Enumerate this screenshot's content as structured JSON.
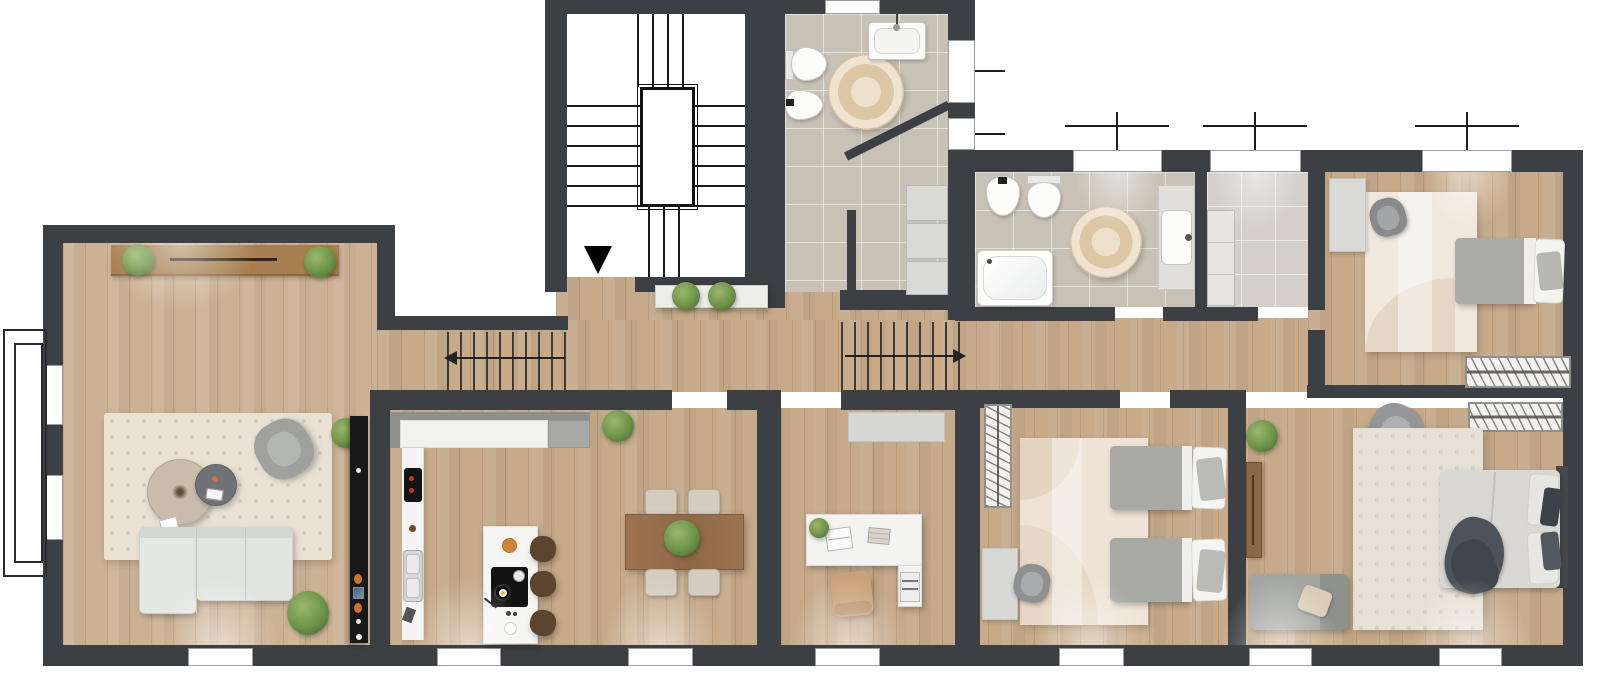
{
  "document": {
    "type": "architectural floor plan",
    "style": "top-down 2D rendered apartment plan, no text labels",
    "wall_color": "#3c3f43",
    "background": "#ffffff"
  },
  "rooms": [
    {
      "id": "stairwell",
      "name": "Stairwell",
      "features": [
        "U-shaped staircase",
        "central stair void",
        "black entry arrow pointing down"
      ]
    },
    {
      "id": "bathroom-1",
      "name": "Bathroom 1",
      "floor": "beige tile",
      "fixtures": [
        "wall-hung toilet",
        "bidet",
        "washbasin with faucet",
        "round jute rug",
        "stacked storage cabinets",
        "diagonal partition wall"
      ],
      "windows": 3
    },
    {
      "id": "entry-hall",
      "name": "Entry hall",
      "furniture": [
        "white console shelf with two green plants"
      ]
    },
    {
      "id": "hallway",
      "name": "Hallway",
      "features": [
        "stair run hatch with arrow pointing left",
        "stair run hatch with arrow pointing right"
      ]
    },
    {
      "id": "bathroom-2",
      "name": "Bathroom 2",
      "floor": "beige tile",
      "fixtures": [
        "bidet",
        "toilet",
        "bathtub",
        "vanity with washbasin",
        "round jute rug"
      ],
      "windows": 1
    },
    {
      "id": "laundry",
      "name": "Laundry / utility room",
      "floor": "light tile",
      "furniture": [
        "tall storage cabinet"
      ],
      "windows": 1
    },
    {
      "id": "bedroom-1",
      "name": "Single bedroom",
      "furniture": [
        "single bed with grey duvet and white pillow",
        "desk",
        "grey swivel chair",
        "cream area rug",
        "radiator / hatched low unit"
      ],
      "windows": 1
    },
    {
      "id": "living-room",
      "name": "Living room",
      "furniture": [
        "wooden sideboard flanked by two plants",
        "L-shaped light grey sofa",
        "large round coffee table",
        "small dark round side table",
        "grey armchair",
        "cream area rug",
        "dark media / aquarium column with decor",
        "two more potted plants"
      ],
      "windows": 4
    },
    {
      "id": "kitchen-dining",
      "name": "Kitchen and dining area",
      "furniture": [
        "wall counter with sink and coffee machine",
        "upper cabinet row",
        "fridge block",
        "island with black cooktop and pan",
        "three brown bar stools",
        "wooden dining table",
        "four beige chairs",
        "table centerpiece plant",
        "doorway plant"
      ],
      "windows": 2
    },
    {
      "id": "office",
      "name": "Home office",
      "furniture": [
        "L-shaped white desk",
        "laptop",
        "desk plant",
        "books",
        "magazine file",
        "tan office chair",
        "grey wall shelf"
      ],
      "windows": 1
    },
    {
      "id": "kids-bedroom",
      "name": "Kids bedroom",
      "furniture": [
        "two single beds with grey duvets and white pillows",
        "hatched wardrobe",
        "desk",
        "grey swivel chair",
        "beige area rug"
      ],
      "windows": 1
    },
    {
      "id": "master-bedroom",
      "name": "Master bedroom",
      "furniture": [
        "double bed with dark throw and layered pillows",
        "hatched wardrobe",
        "chest of drawers",
        "grey armchair",
        "chaise lounge with beige cushion",
        "large speckled rug",
        "corner plant"
      ],
      "windows": 2
    }
  ],
  "symbols": {
    "entry_arrow": "solid black triangle pointing down at stairwell landing",
    "stair_direction_left": "hallway stair hatch, arrow points left",
    "stair_direction_right": "hallway stair hatch, arrow points right",
    "window_casement_marks": "thin perpendicular tick lines outside top and side windows",
    "balcony_outline": "double rectangle railing outline outside the left living-room windows"
  },
  "counts": {
    "rooms": 12,
    "bottom_windows": 7,
    "top_windows": 3,
    "left_windows": 2,
    "courtyard_side_windows": 3,
    "beds": 4,
    "bar_stools": 3,
    "dining_chairs": 4,
    "plants": 10
  },
  "palette": {
    "wall": "#3c3f43",
    "wood_floor": "#c6aa8a",
    "living_floor": "#ccb295",
    "tile_floor": "#c8c1b6",
    "tile_light": "#d4d0c9",
    "rug_cream": "#e9e1d4",
    "sofa_grey": "#e2e4e1",
    "duvet_grey": "#a7a9a2",
    "sideboard_wood": "#a67e50",
    "dining_table_wood": "#9b7351",
    "stool_brown": "#5b452f",
    "office_chair_tan": "#c9a27a",
    "plant_green": "#6d9347",
    "throw_dark": "#4c535a",
    "cabinet_grey": "#d6d6d4"
  }
}
